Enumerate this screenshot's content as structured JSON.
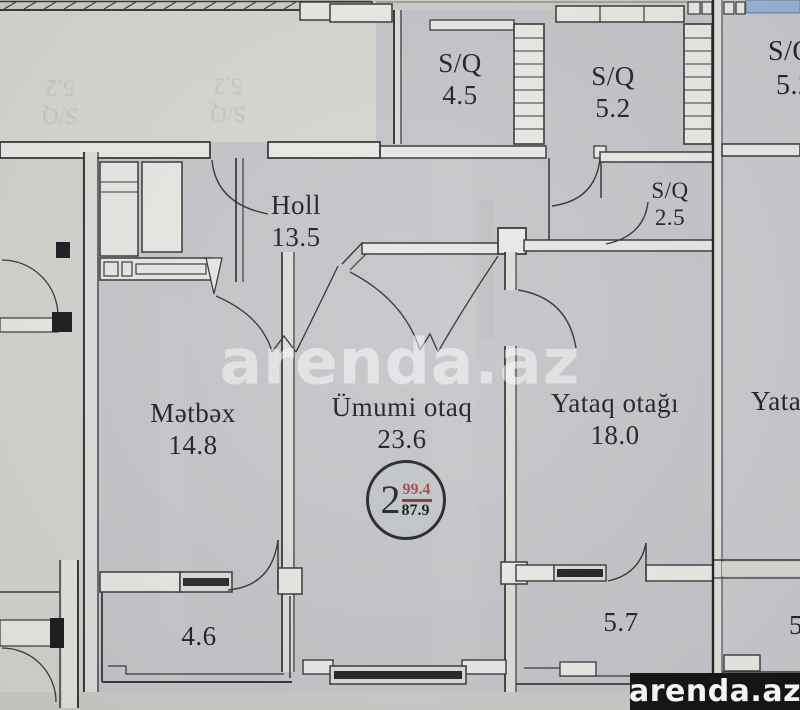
{
  "rooms": {
    "sq_45": {
      "name": "S/Q",
      "area": "4.5"
    },
    "sq_52": {
      "name": "S/Q",
      "area": "5.2"
    },
    "sq_25": {
      "name": "S/Q",
      "area": "2.5"
    },
    "holl": {
      "name": "Holl",
      "area": "13.5"
    },
    "metbex": {
      "name": "Mətbəx",
      "area": "14.8"
    },
    "umumi_otaq": {
      "name": "Ümumi otaq",
      "area": "23.6"
    },
    "yataq_otagi": {
      "name": "Yataq otağı",
      "area": "18.0"
    },
    "balcony_left": {
      "area": "4.6"
    },
    "balcony_right": {
      "area": "5.7"
    }
  },
  "neighbor_unit": {
    "sq_partial_name": "S/Q",
    "sq_partial_area": "5.2",
    "bedroom_partial": "Yata",
    "balcony_partial": "5"
  },
  "ghost_label": {
    "name": "S/Q",
    "area": "5.2"
  },
  "unit_badge": {
    "room_count": "2",
    "total_area": "99.4",
    "living_area": "87.9"
  },
  "watermark": {
    "center": "arenda.az",
    "corner": "arenda.az"
  },
  "colors": {
    "paper": "#c5c7ca",
    "adjacent_paper": "#d8d7d1",
    "wall_line": "#3a3a3d",
    "wall_fill": "#eceae6",
    "window_glass": "#28282b",
    "total_area_red": "#a34f4f",
    "blue_strip": "#9ab5d7",
    "logo_background": "#151515",
    "watermark_white": "#ffffff"
  }
}
